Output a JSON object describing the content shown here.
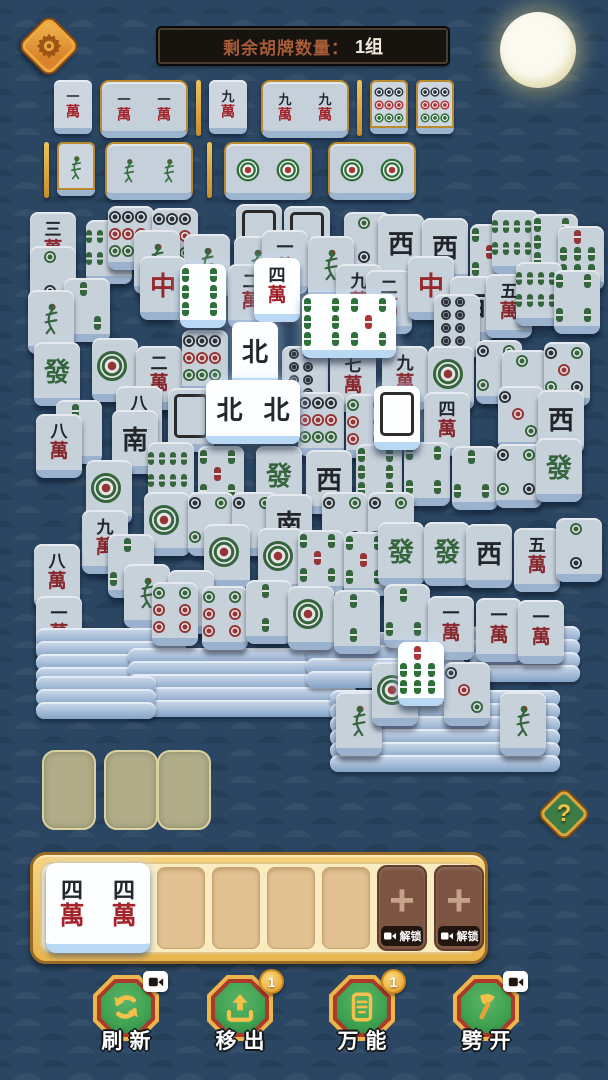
{
  "header": {
    "counter_label": "剩余胡牌数量：",
    "counter_value": "1组"
  },
  "help": {
    "label": "?"
  },
  "colors": {
    "accent_gold": "#e7b54a",
    "tile_red": "#a3242b",
    "tile_green": "#2f6f3a",
    "tile_black": "#23282f",
    "background": "#2a4662",
    "bright_tile": "#fdfeff"
  },
  "tile_glyphs": {
    "w1": [
      "一",
      "萬"
    ],
    "w2": [
      "二",
      "萬"
    ],
    "w3": [
      "三",
      "萬"
    ],
    "w4": [
      "四",
      "萬"
    ],
    "w5": [
      "五",
      "萬"
    ],
    "w7": [
      "七",
      "萬"
    ],
    "w8": [
      "八",
      "萬"
    ],
    "w9": [
      "九",
      "萬"
    ],
    "zhong": "中",
    "fa": "發",
    "bei": "北",
    "nan": "南",
    "xi": "西"
  },
  "goal_sets": {
    "row1": [
      {
        "kind": "tile",
        "f": "w1"
      },
      {
        "kind": "group",
        "f": [
          "w1",
          "w1"
        ]
      },
      {
        "kind": "sep"
      },
      {
        "kind": "tile",
        "f": "w9"
      },
      {
        "kind": "group",
        "f": [
          "w9",
          "w9"
        ]
      },
      {
        "kind": "sep"
      },
      {
        "kind": "ctile",
        "f": "d9"
      },
      {
        "kind": "ctile",
        "f": "d9"
      }
    ],
    "row2": [
      {
        "kind": "sep"
      },
      {
        "kind": "ctile",
        "f": "bird"
      },
      {
        "kind": "group",
        "f": [
          "bird",
          "bird"
        ]
      },
      {
        "kind": "sep"
      },
      {
        "kind": "group",
        "f": [
          "d1",
          "d1"
        ]
      },
      {
        "kind": "group",
        "f": [
          "d1",
          "d1"
        ]
      }
    ]
  },
  "board": [
    {
      "x": 30,
      "y": 212,
      "f": "w3"
    },
    {
      "x": 86,
      "y": 220,
      "f": "b8"
    },
    {
      "x": 108,
      "y": 206,
      "f": "d9"
    },
    {
      "x": 152,
      "y": 208,
      "f": "d9"
    },
    {
      "x": 236,
      "y": 204,
      "f": "blank"
    },
    {
      "x": 284,
      "y": 206,
      "f": "blank"
    },
    {
      "x": 344,
      "y": 212,
      "f": "d2"
    },
    {
      "x": 378,
      "y": 214,
      "f": "xi"
    },
    {
      "x": 422,
      "y": 218,
      "f": "xi"
    },
    {
      "x": 470,
      "y": 224,
      "f": "b5"
    },
    {
      "x": 492,
      "y": 210,
      "f": "b8"
    },
    {
      "x": 532,
      "y": 214,
      "f": "b6"
    },
    {
      "x": 558,
      "y": 226,
      "f": "b7"
    },
    {
      "x": 30,
      "y": 246,
      "f": "d2"
    },
    {
      "x": 134,
      "y": 230,
      "f": "bird"
    },
    {
      "x": 184,
      "y": 234,
      "f": "bird"
    },
    {
      "x": 234,
      "y": 236,
      "f": "bird"
    },
    {
      "x": 262,
      "y": 230,
      "f": "w1"
    },
    {
      "x": 308,
      "y": 236,
      "f": "bird"
    },
    {
      "x": 140,
      "y": 256,
      "f": "zhong"
    },
    {
      "x": 228,
      "y": 264,
      "f": "w2"
    },
    {
      "x": 336,
      "y": 264,
      "f": "w9"
    },
    {
      "x": 366,
      "y": 270,
      "f": "w2"
    },
    {
      "x": 408,
      "y": 256,
      "f": "zhong"
    },
    {
      "x": 450,
      "y": 276,
      "f": "xi"
    },
    {
      "x": 486,
      "y": 274,
      "f": "w5"
    },
    {
      "x": 516,
      "y": 262,
      "f": "b8"
    },
    {
      "x": 554,
      "y": 270,
      "f": "b4"
    },
    {
      "x": 64,
      "y": 278,
      "f": "b3"
    },
    {
      "x": 28,
      "y": 290,
      "f": "bird"
    },
    {
      "x": 34,
      "y": 342,
      "f": "fa"
    },
    {
      "x": 92,
      "y": 338,
      "f": "d1"
    },
    {
      "x": 136,
      "y": 346,
      "f": "w2"
    },
    {
      "x": 182,
      "y": 330,
      "f": "d9"
    },
    {
      "x": 282,
      "y": 346,
      "f": "d8"
    },
    {
      "x": 330,
      "y": 348,
      "f": "w7"
    },
    {
      "x": 382,
      "y": 346,
      "f": "w9"
    },
    {
      "x": 434,
      "y": 294,
      "f": "d8"
    },
    {
      "x": 428,
      "y": 346,
      "f": "d1"
    },
    {
      "x": 476,
      "y": 340,
      "f": "d4"
    },
    {
      "x": 502,
      "y": 350,
      "f": "d2"
    },
    {
      "x": 544,
      "y": 342,
      "f": "d5"
    },
    {
      "x": 116,
      "y": 386,
      "f": "w8"
    },
    {
      "x": 168,
      "y": 388,
      "f": "blank"
    },
    {
      "x": 298,
      "y": 392,
      "f": "d9"
    },
    {
      "x": 346,
      "y": 394,
      "f": "d6"
    },
    {
      "x": 424,
      "y": 392,
      "f": "w4"
    },
    {
      "x": 498,
      "y": 386,
      "f": "d3"
    },
    {
      "x": 538,
      "y": 390,
      "f": "xi"
    },
    {
      "x": 56,
      "y": 400,
      "f": "b2"
    },
    {
      "x": 36,
      "y": 414,
      "f": "w8"
    },
    {
      "x": 112,
      "y": 410,
      "f": "nan"
    },
    {
      "x": 148,
      "y": 442,
      "f": "b8"
    },
    {
      "x": 198,
      "y": 446,
      "f": "b5"
    },
    {
      "x": 256,
      "y": 446,
      "f": "fa"
    },
    {
      "x": 306,
      "y": 450,
      "f": "xi"
    },
    {
      "x": 356,
      "y": 444,
      "f": "b6"
    },
    {
      "x": 404,
      "y": 442,
      "f": "b4"
    },
    {
      "x": 452,
      "y": 446,
      "f": "b3"
    },
    {
      "x": 496,
      "y": 444,
      "f": "d4"
    },
    {
      "x": 536,
      "y": 438,
      "f": "fa"
    },
    {
      "x": 86,
      "y": 460,
      "f": "d1"
    },
    {
      "x": 144,
      "y": 492,
      "f": "d1"
    },
    {
      "x": 188,
      "y": 492,
      "f": "d4"
    },
    {
      "x": 232,
      "y": 492,
      "f": "d4"
    },
    {
      "x": 266,
      "y": 494,
      "f": "nan"
    },
    {
      "x": 322,
      "y": 492,
      "f": "d4"
    },
    {
      "x": 368,
      "y": 492,
      "f": "d4"
    },
    {
      "x": 82,
      "y": 510,
      "f": "w9"
    },
    {
      "x": 108,
      "y": 534,
      "f": "b3"
    },
    {
      "x": 204,
      "y": 524,
      "f": "d1"
    },
    {
      "x": 258,
      "y": 528,
      "f": "d1"
    },
    {
      "x": 298,
      "y": 530,
      "f": "b5"
    },
    {
      "x": 344,
      "y": 532,
      "f": "b5"
    },
    {
      "x": 378,
      "y": 522,
      "f": "fa"
    },
    {
      "x": 424,
      "y": 522,
      "f": "fa"
    },
    {
      "x": 466,
      "y": 524,
      "f": "xi"
    },
    {
      "x": 514,
      "y": 528,
      "f": "w5"
    },
    {
      "x": 556,
      "y": 518,
      "f": "d2"
    },
    {
      "x": 34,
      "y": 544,
      "f": "w8"
    },
    {
      "x": 124,
      "y": 564,
      "f": "bird"
    },
    {
      "x": 168,
      "y": 570,
      "f": "bird"
    },
    {
      "x": 36,
      "y": 596,
      "f": "w1"
    },
    {
      "stack": true,
      "x": 36,
      "y": 628,
      "w": 150,
      "rows": 4
    },
    {
      "stack": true,
      "x": 128,
      "y": 648,
      "w": 230,
      "rows": 5
    },
    {
      "stack": true,
      "x": 306,
      "y": 632,
      "w": 160,
      "rows": 4
    },
    {
      "stack": true,
      "x": 470,
      "y": 626,
      "w": 110,
      "rows": 4
    },
    {
      "stack": true,
      "x": 36,
      "y": 676,
      "w": 120,
      "rows": 3
    },
    {
      "x": 152,
      "y": 582,
      "f": "d6"
    },
    {
      "x": 202,
      "y": 586,
      "f": "d6"
    },
    {
      "x": 246,
      "y": 580,
      "f": "b2"
    },
    {
      "x": 288,
      "y": 586,
      "f": "d1"
    },
    {
      "x": 334,
      "y": 590,
      "f": "b2"
    },
    {
      "x": 384,
      "y": 584,
      "f": "b3"
    },
    {
      "x": 428,
      "y": 596,
      "f": "w1"
    },
    {
      "x": 476,
      "y": 598,
      "f": "w1"
    },
    {
      "x": 518,
      "y": 600,
      "f": "w1"
    },
    {
      "stack": true,
      "x": 330,
      "y": 690,
      "w": 230,
      "rows": 6
    },
    {
      "x": 336,
      "y": 692,
      "f": "bird"
    },
    {
      "x": 372,
      "y": 662,
      "f": "d1"
    },
    {
      "x": 444,
      "y": 662,
      "f": "d3"
    },
    {
      "x": 500,
      "y": 692,
      "f": "bird"
    },
    {
      "x": 180,
      "y": 264,
      "f": "b6",
      "hl": true
    },
    {
      "x": 254,
      "y": 258,
      "f": "w4",
      "hl": true
    },
    {
      "x": 302,
      "y": 294,
      "f": [
        "b6",
        "b5"
      ],
      "hl": true
    },
    {
      "x": 232,
      "y": 322,
      "f": "bei",
      "hl": true
    },
    {
      "x": 206,
      "y": 380,
      "f": [
        "bei",
        "bei"
      ],
      "hl": true
    },
    {
      "x": 374,
      "y": 386,
      "f": "blank",
      "hl": true
    },
    {
      "x": 398,
      "y": 642,
      "f": "b7",
      "hl": true
    }
  ],
  "tray": {
    "slots": [
      {
        "state": "filled",
        "f": [
          "w4",
          "w4"
        ]
      },
      {
        "state": "empty"
      },
      {
        "state": "empty"
      },
      {
        "state": "empty"
      },
      {
        "state": "empty"
      },
      {
        "state": "locked",
        "label": "解锁"
      },
      {
        "state": "locked",
        "label": "解锁"
      }
    ]
  },
  "action_buttons": [
    {
      "id": "refresh",
      "label": "刷新",
      "badge": "ad"
    },
    {
      "id": "move-out",
      "label": "移出",
      "badge": "1"
    },
    {
      "id": "wildcard",
      "label": "万能",
      "badge": "1"
    },
    {
      "id": "split",
      "label": "劈开",
      "badge": "ad"
    }
  ]
}
